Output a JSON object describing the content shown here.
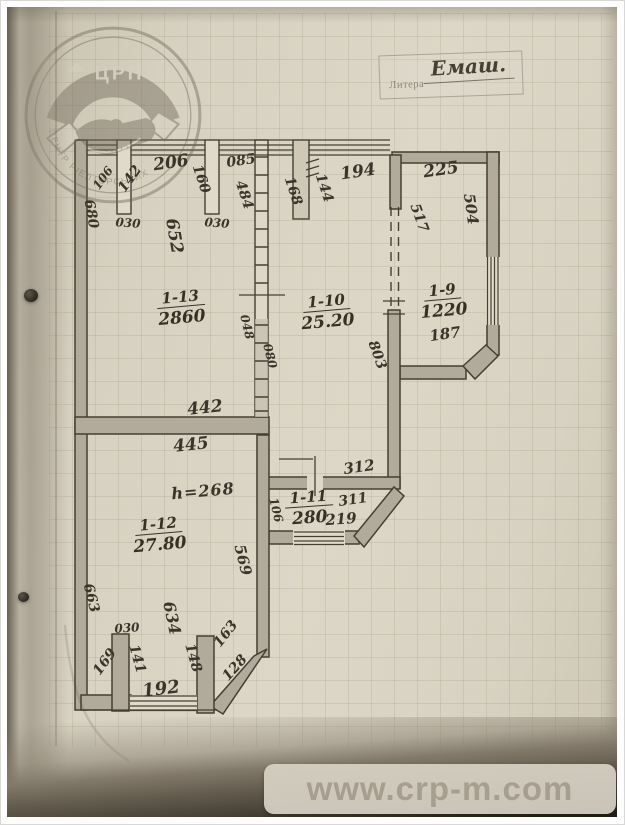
{
  "watermark": {
    "url": "www.crp-m.com"
  },
  "litera": {
    "label": "Литера",
    "value": "Емаш."
  },
  "logo": {
    "abbr": "ЦРП",
    "arc1": "ЦЕНТР РІЕЛТОРСЬКИХ",
    "arc2": "ПОСЛУГ"
  },
  "plan": {
    "rooms": [
      {
        "id": "1-13",
        "area": "2860",
        "x": 174,
        "y": 300,
        "r": -5
      },
      {
        "id": "1-10",
        "area": "25.20",
        "x": 320,
        "y": 304,
        "r": -5
      },
      {
        "id": "1-9",
        "area": "1220",
        "x": 436,
        "y": 293,
        "r": -5
      },
      {
        "id": "1-11",
        "area": "280",
        "x": 302,
        "y": 500,
        "r": -4
      },
      {
        "id": "1-12",
        "area": "27.80",
        "x": 152,
        "y": 527,
        "r": -5
      }
    ],
    "annotations": [
      {
        "text": "680",
        "x": 84,
        "y": 207,
        "r": 80,
        "fs": 14
      },
      {
        "text": "106",
        "x": 96,
        "y": 171,
        "r": -54,
        "fs": 12
      },
      {
        "text": "142",
        "x": 123,
        "y": 172,
        "r": -54,
        "fs": 14
      },
      {
        "text": "030",
        "x": 121,
        "y": 216,
        "r": 4,
        "fs": 12
      },
      {
        "text": "206",
        "x": 164,
        "y": 156,
        "r": -8,
        "fs": 17
      },
      {
        "text": "652",
        "x": 167,
        "y": 229,
        "r": 80,
        "fs": 17
      },
      {
        "text": "160",
        "x": 194,
        "y": 172,
        "r": 72,
        "fs": 14
      },
      {
        "text": "030",
        "x": 210,
        "y": 216,
        "r": 4,
        "fs": 12
      },
      {
        "text": "085",
        "x": 234,
        "y": 154,
        "r": -8,
        "fs": 14
      },
      {
        "text": "484",
        "x": 237,
        "y": 188,
        "r": 72,
        "fs": 14
      },
      {
        "text": "168",
        "x": 286,
        "y": 184,
        "r": 72,
        "fs": 14
      },
      {
        "text": "144",
        "x": 317,
        "y": 181,
        "r": 72,
        "fs": 14
      },
      {
        "text": "194",
        "x": 351,
        "y": 165,
        "r": -8,
        "fs": 17
      },
      {
        "text": "225",
        "x": 434,
        "y": 163,
        "r": -8,
        "fs": 17
      },
      {
        "text": "517",
        "x": 412,
        "y": 211,
        "r": 70,
        "fs": 14
      },
      {
        "text": "504",
        "x": 464,
        "y": 202,
        "r": 82,
        "fs": 15
      },
      {
        "text": "048",
        "x": 240,
        "y": 320,
        "r": 76,
        "fs": 12
      },
      {
        "text": "080",
        "x": 263,
        "y": 349,
        "r": 76,
        "fs": 12
      },
      {
        "text": "803",
        "x": 370,
        "y": 348,
        "r": 70,
        "fs": 14
      },
      {
        "text": "187",
        "x": 438,
        "y": 327,
        "r": -8,
        "fs": 15
      },
      {
        "text": "442",
        "x": 198,
        "y": 401,
        "r": -6,
        "fs": 17
      },
      {
        "text": "445",
        "x": 184,
        "y": 438,
        "r": -6,
        "fs": 17
      },
      {
        "text": "h=268",
        "x": 196,
        "y": 484,
        "r": -5,
        "fs": 16,
        "cls": "script"
      },
      {
        "text": "312",
        "x": 352,
        "y": 460,
        "r": -8,
        "fs": 15
      },
      {
        "text": "311",
        "x": 346,
        "y": 493,
        "r": -8,
        "fs": 14
      },
      {
        "text": "219",
        "x": 334,
        "y": 512,
        "r": -4,
        "fs": 15
      },
      {
        "text": "106",
        "x": 269,
        "y": 503,
        "r": 76,
        "fs": 12
      },
      {
        "text": "569",
        "x": 236,
        "y": 553,
        "r": 76,
        "fs": 15
      },
      {
        "text": "663",
        "x": 84,
        "y": 591,
        "r": 76,
        "fs": 14
      },
      {
        "text": "634",
        "x": 165,
        "y": 611,
        "r": 78,
        "fs": 16
      },
      {
        "text": "030",
        "x": 120,
        "y": 621,
        "r": -4,
        "fs": 12
      },
      {
        "text": "169",
        "x": 98,
        "y": 655,
        "r": -54,
        "fs": 14
      },
      {
        "text": "141",
        "x": 130,
        "y": 652,
        "r": 74,
        "fs": 14
      },
      {
        "text": "148",
        "x": 186,
        "y": 651,
        "r": 74,
        "fs": 14
      },
      {
        "text": "163",
        "x": 219,
        "y": 627,
        "r": -52,
        "fs": 14
      },
      {
        "text": "128",
        "x": 228,
        "y": 661,
        "r": -48,
        "fs": 14
      },
      {
        "text": "192",
        "x": 154,
        "y": 682,
        "r": -7,
        "fs": 18
      }
    ]
  }
}
